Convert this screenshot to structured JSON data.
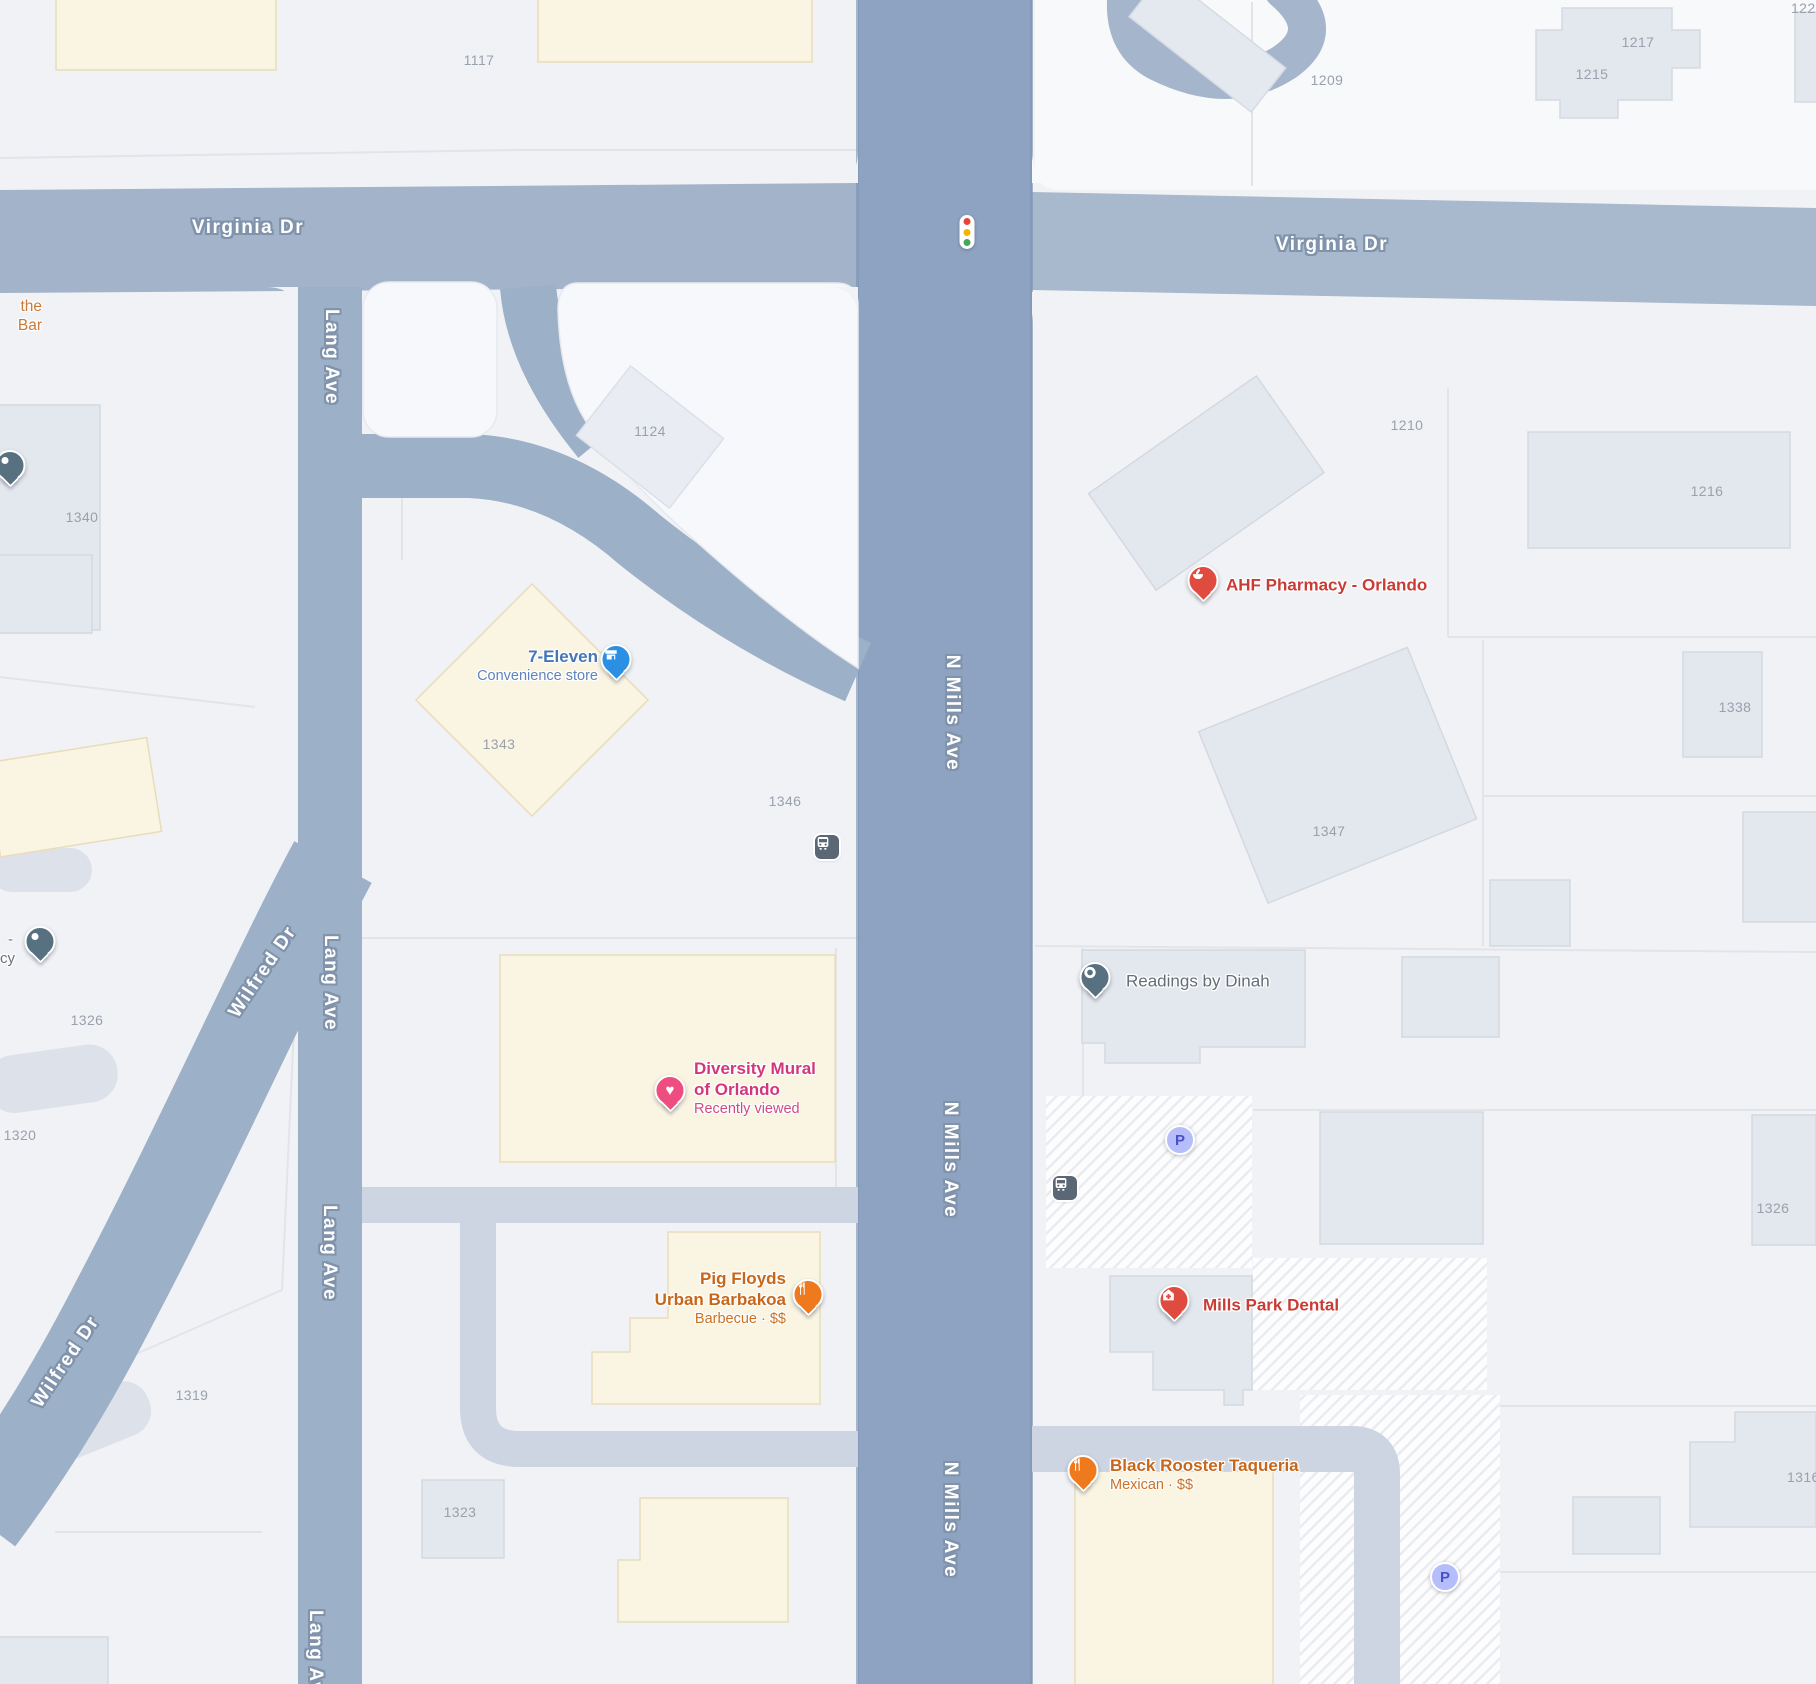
{
  "roads": {
    "virginia_dr": "Virginia Dr",
    "n_mills_ave": "N Mills Ave",
    "lang_ave": "Lang Ave",
    "wilfred_dr": "Wilfred Dr"
  },
  "pois": {
    "seven_eleven": {
      "name": "7-Eleven",
      "category": "Convenience store"
    },
    "ahf_pharmacy": {
      "name": "AHF Pharmacy - Orlando"
    },
    "readings_by_dinah": {
      "name": "Readings by Dinah"
    },
    "diversity_mural": {
      "name_line1": "Diversity Mural",
      "name_line2": "of Orlando",
      "status": "Recently viewed"
    },
    "pig_floyds": {
      "name_line1": "Pig Floyds",
      "name_line2": "Urban Barbakoa",
      "category": "Barbecue · $$"
    },
    "mills_park_dental": {
      "name": "Mills Park Dental"
    },
    "black_rooster": {
      "name": "Black Rooster Taqueria",
      "category": "Mexican · $$"
    },
    "partial_top_left": {
      "line1": "the",
      "line2": "Bar"
    },
    "partial_left": {
      "line1": "-",
      "line2": "cy"
    }
  },
  "addresses": {
    "n1117": "1117",
    "n122x": "122",
    "n1217": "1217",
    "n1215": "1215",
    "n1209": "1209",
    "n1340": "1340",
    "n1124": "1124",
    "n1210": "1210",
    "n1216": "1216",
    "n1338": "1338",
    "n1343": "1343",
    "n1346": "1346",
    "n1347": "1347",
    "n1326_left": "1326",
    "n1320": "1320",
    "n1319": "1319",
    "n1323": "1323",
    "n1326_right": "1326",
    "n1316": "1316"
  },
  "misc": {
    "parking_label": "P"
  },
  "colors": {
    "major_road": "#9fb1c8",
    "n_mills_road": "#8da3c1",
    "minor_road": "#cdd5e2",
    "building_gray": "#e3e7ee",
    "building_cream": "#faf4e2",
    "poi_blue": "#4576b5",
    "poi_red": "#c93c35",
    "poi_pink": "#d2377b",
    "poi_orange": "#c8661a",
    "poi_gray": "#646e77",
    "pin_blue": "#2b8fe3",
    "pin_red": "#e04b40",
    "pin_pink": "#ee4d80",
    "pin_orange": "#ef7a1d",
    "pin_slate": "#577180",
    "parking_icon_bg": "#b5befa",
    "bus_icon_bg": "#5b6775",
    "signal_red": "#e84335",
    "signal_yellow": "#f5b400",
    "signal_green": "#43a853"
  }
}
